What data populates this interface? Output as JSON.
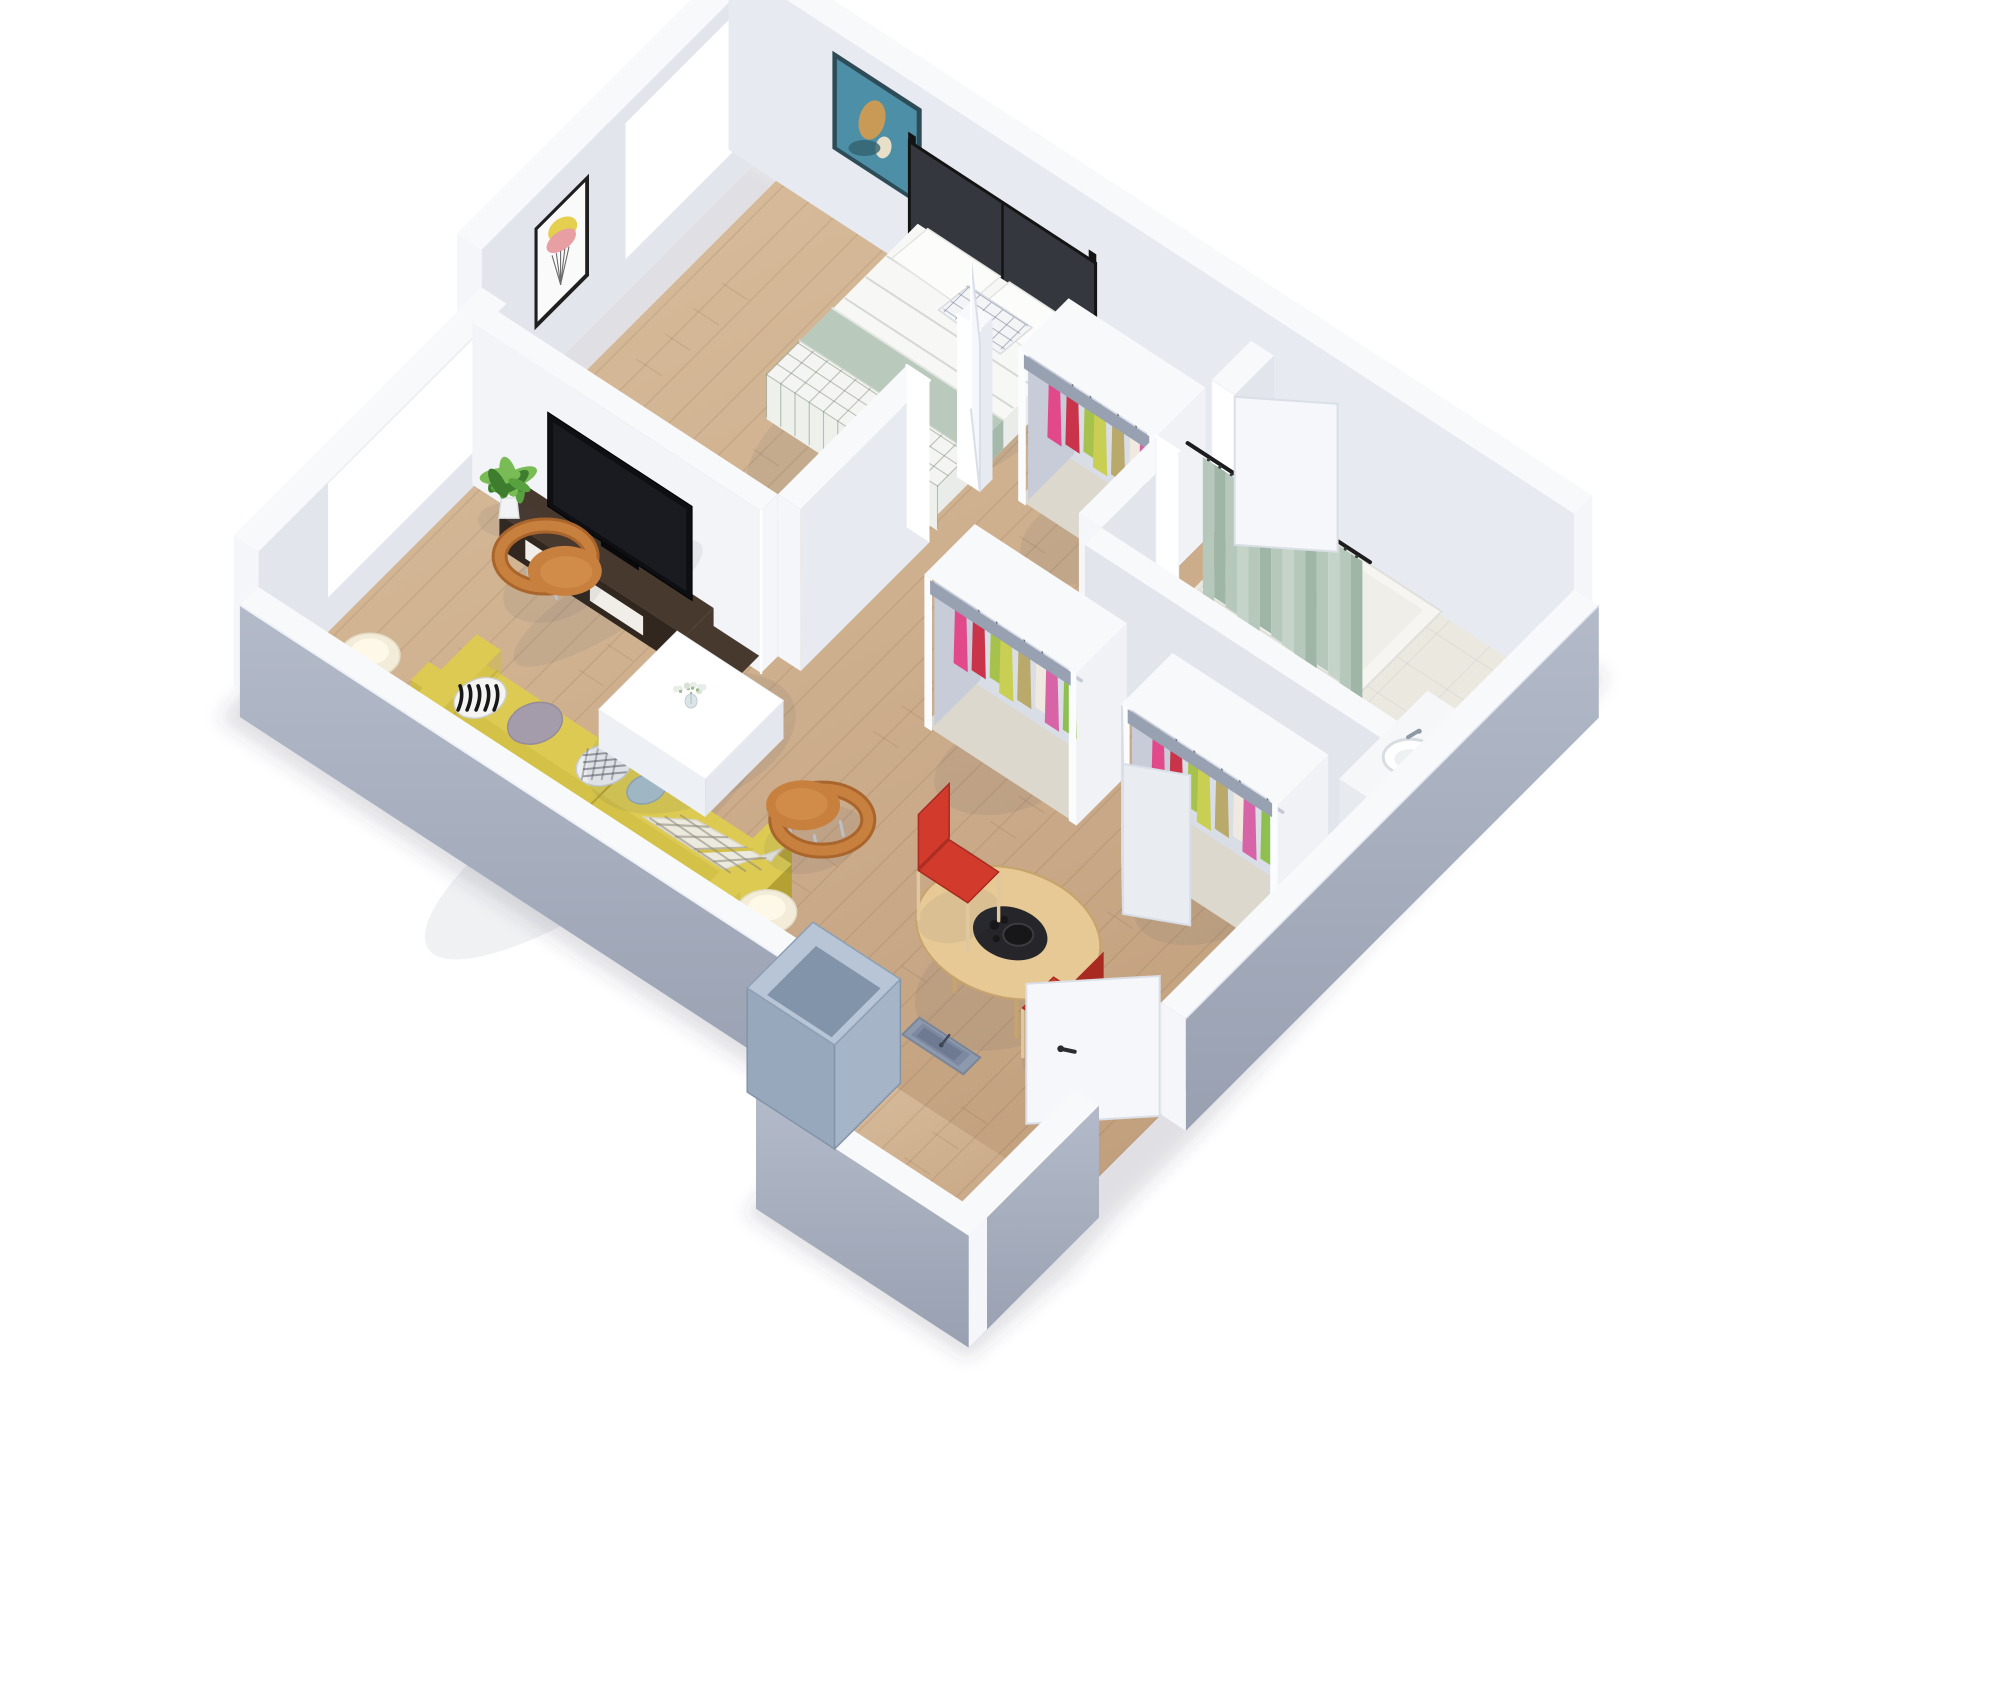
{
  "title": "3d-apartment-floor-plan-render",
  "scene": {
    "canvas": {
      "width": 2000,
      "height": 1700,
      "background": "#ffffff"
    },
    "rooms": [
      "living-room",
      "bedroom",
      "bathroom",
      "hallway",
      "entry"
    ],
    "furniture": [
      "bed",
      "headboard",
      "wardrobe-bedroom",
      "wardrobe-hall-a",
      "wardrobe-hall-b",
      "bedroom-armchair",
      "bedroom-side-table",
      "tv",
      "tv-console",
      "sofa",
      "coffee-table",
      "armchair-window",
      "armchair-floor",
      "console-table",
      "table-lamp-1",
      "table-lamp-2",
      "plant-1",
      "plant-2",
      "dining-table",
      "dining-chair-1",
      "dining-chair-2",
      "shower",
      "shower-curtain",
      "sink",
      "toilet",
      "entry-door",
      "bedroom-door",
      "bathroom-door",
      "folding-doors",
      "wall-recessed-box",
      "utility-cube",
      "art-abstract-blue",
      "art-geometric",
      "window-living",
      "window-bedroom",
      "coffee-table-flowers",
      "tray-tea-set",
      "sofa-pillows",
      "plaid-throw"
    ],
    "clothes_palette": [
      "#e2498a",
      "#c9344a",
      "#a6c24c",
      "#c9cf52",
      "#b9a96b",
      "#efe9df",
      "#d864a8",
      "#8fbf4e"
    ],
    "colors": {
      "background": "#ffffff",
      "wallTop": "#f8f9fb",
      "wallInner": "#e2e5ec",
      "wallInner2": "#e7eaf0",
      "wallBright": "#f2f4f8",
      "wallOuter": "#b3bac9",
      "wallOuterDark": "#98a0b1",
      "wallCap": "#f5f6f9",
      "floorWoodLight": "#dabf9e",
      "floorWoodDark": "#c2a07e",
      "floorSeam": "rgba(120,85,55,0.14)",
      "bathFloor": "#ebe8e0",
      "showerBase": "#f6f5f1",
      "glass": "#ffffff",
      "frameWhite": "#ffffff",
      "artBlueBg": "#4d8fa6",
      "artBlueDark": "#33616f",
      "artBlueGold": "#c89a55",
      "artWhite": "#fafafa",
      "artYellow": "#e5cf4e",
      "artPink": "#e79fa4",
      "artLine": "#6b6b6b",
      "bedFrame": "#141414",
      "headboard": "#34373d",
      "mattress": "#f7f8f6",
      "mattressSide": "#e9ece8",
      "mattressFoot": "#e6e8e4",
      "blanketSage": "#b9cabd",
      "blanketSageDark": "#a5b9ab",
      "gridLine": "rgba(125,140,120,0.5)",
      "pillowWhite": "#fcfcfb",
      "pillowCheckLine": "rgba(120,130,150,0.55)",
      "chairPeach": "#ecc096",
      "chairPeachDark": "#d9a477",
      "sideTableWood": "#e9d2a8",
      "tvCabinet": "#47392e",
      "tvCabinetDark": "#31271e",
      "drawerWhite": "#f1eee9",
      "tvBlack": "#0e0f12",
      "tvDark": "#25272c",
      "plantGreen": "#58a13f",
      "plantDark": "#3f7d2e",
      "plantLight": "#79bc55",
      "potWhite": "#f2f3f4",
      "sofaYellow": "#dcca52",
      "sofaYellowMid": "#cdbb43",
      "sofaYellowDark": "#b3a233",
      "pillowGray": "#a59cab",
      "pillowBlue": "#a8bfcc",
      "throwWhite": "#eceade",
      "throwLine": "rgba(140,135,120,0.55)",
      "armchairTan": "#c8803f",
      "armchairTanDark": "#a9652c",
      "legSilver": "#b9c0c9",
      "tableWhiteTop": "#ffffff",
      "tableWhiteSide": "#edf0f4",
      "tableWhiteSide2": "#e4e8ee",
      "glassTop": "rgba(213,226,233,0.55)",
      "glassFrame": "#4a4843",
      "lampShade": "#f2ecd8",
      "lampGlow": "#fdf8e8",
      "lampBase": "#cfd6da",
      "diningWood": "#e6c995",
      "diningWoodDark": "#c6a46c",
      "trayBlack": "#26262a",
      "trayBlack2": "#17171a",
      "chairRed": "#d23a2c",
      "chairRedDark": "#a92a20",
      "legWood": "#dfc89e",
      "closetBox": "#f1f2f6",
      "closetRim": "#97a1b2",
      "closetInside": "#d9dde6",
      "closetInsideDark": "#c7ccd8",
      "closetFloor": "#ddd8cd",
      "rail": "#c3cad6",
      "hanger": "#6f7680",
      "curtainSage": "#b6c8bb",
      "curtainSageDark": "#9fb5a5",
      "curtainSageLight": "#c5d4c8",
      "rodBlack": "#1c1c1e",
      "sinkWhite": "#ffffff",
      "sinkShadow": "#d8dde2",
      "faucet": "#8f99a4",
      "counterWhite": "#f6f7f9",
      "counterSide": "#e7ebf0",
      "toiletWhite": "#f4f6f7",
      "doorLeaf": "#f5f7fa",
      "doorLeaf2": "#e9edf2",
      "doorEdge": "#d9dee7",
      "handleBlack": "#2a2c2f",
      "safeFrame": "#8d99ad",
      "safeFace": "#7c89a0",
      "safeInner": "#66738b",
      "cubeTop": "#b7c5d6",
      "cubeSide": "#97a7bc",
      "cubeFront": "#a5b4c7",
      "cubeInner": "#8294aa",
      "shadow": "rgba(70,80,100,0.08)",
      "buildingShadow": "rgba(60,70,90,0.16)"
    }
  }
}
